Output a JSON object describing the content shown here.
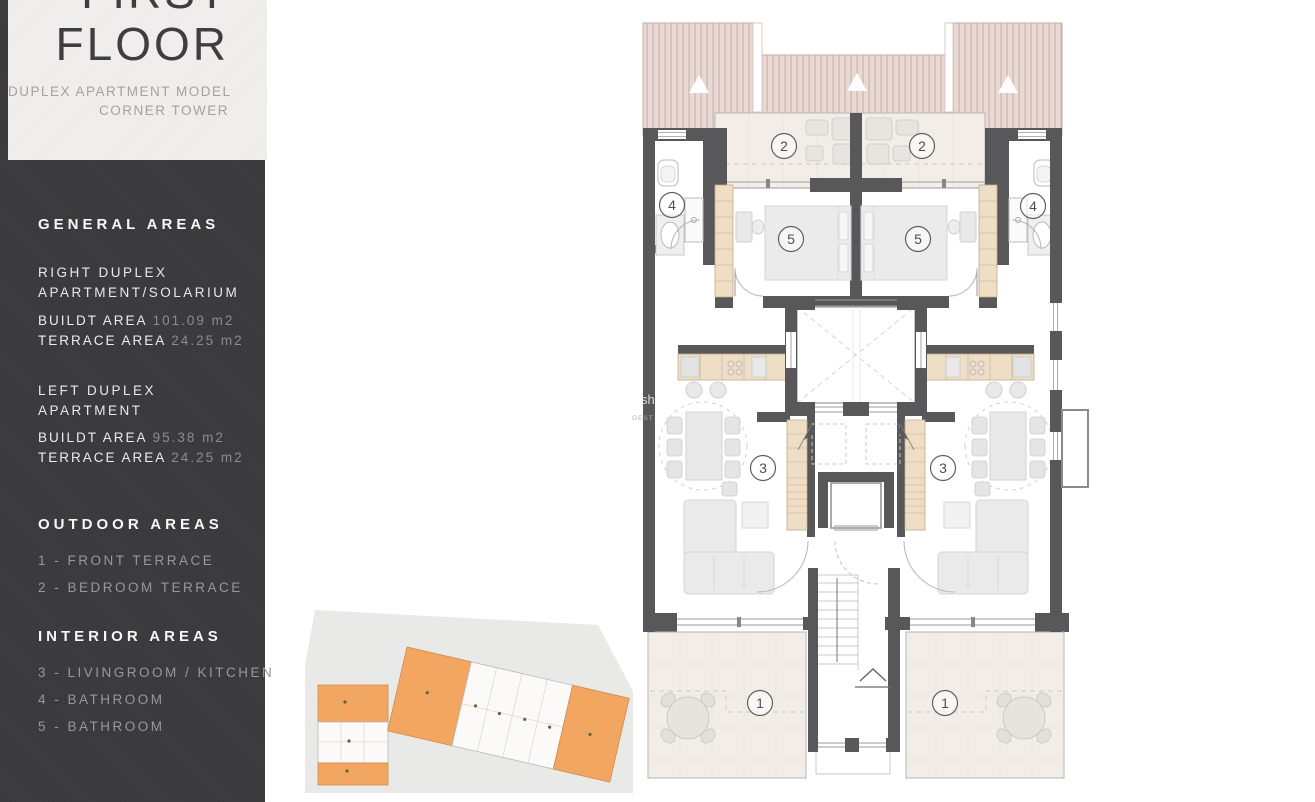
{
  "title_block": {
    "floor_word_top": "FIRST",
    "floor_word_bottom": "FLOOR",
    "subtitle_line1": "DUPLEX APARTMENT MODEL",
    "subtitle_line2": "CORNER TOWER"
  },
  "sidebar": {
    "general": {
      "heading": "GENERAL AREAS",
      "right_duplex": {
        "name_line1": "RIGHT DUPLEX",
        "name_line2": "APARTMENT/SOLARIUM",
        "metrics": [
          {
            "label": "BUILDT AREA",
            "value": "101.09 m2"
          },
          {
            "label": "TERRACE AREA",
            "value": "24.25 m2"
          }
        ]
      },
      "left_duplex": {
        "name_line1": "LEFT DUPLEX",
        "name_line2": "APARTMENT",
        "metrics": [
          {
            "label": "BUILDT AREA",
            "value": "95.38 m2"
          },
          {
            "label": "TERRACE AREA",
            "value": "24.25 m2"
          }
        ]
      }
    },
    "outdoor": {
      "heading": "OUTDOOR AREAS",
      "items": [
        "1 - FRONT TERRACE",
        "2 - BEDROOM TERRACE"
      ]
    },
    "interior": {
      "heading": "INTERIOR AREAS",
      "items": [
        "3 - LIVINGROOM / KITCHEN",
        "4 - BATHROOM",
        "5 - BATHROOM"
      ]
    }
  },
  "floor_plan": {
    "labels": {
      "front_terrace": "1",
      "bedroom_terrace": "2",
      "livingroom_kitchen": "3",
      "bathroom_upper": "4",
      "bathroom_lower": "5"
    },
    "watermark_line1": "sh",
    "watermark_line2": "GEST"
  },
  "colors": {
    "sidebar_bg": "#3a3a3c",
    "wall": "#58585a",
    "roof": "#e8d8d3",
    "terrace_floor": "#f2eee7",
    "cabinet_tan": "#efdec6",
    "keyplan_orange": "#f2a660",
    "value_gray": "#8c8c8f"
  }
}
